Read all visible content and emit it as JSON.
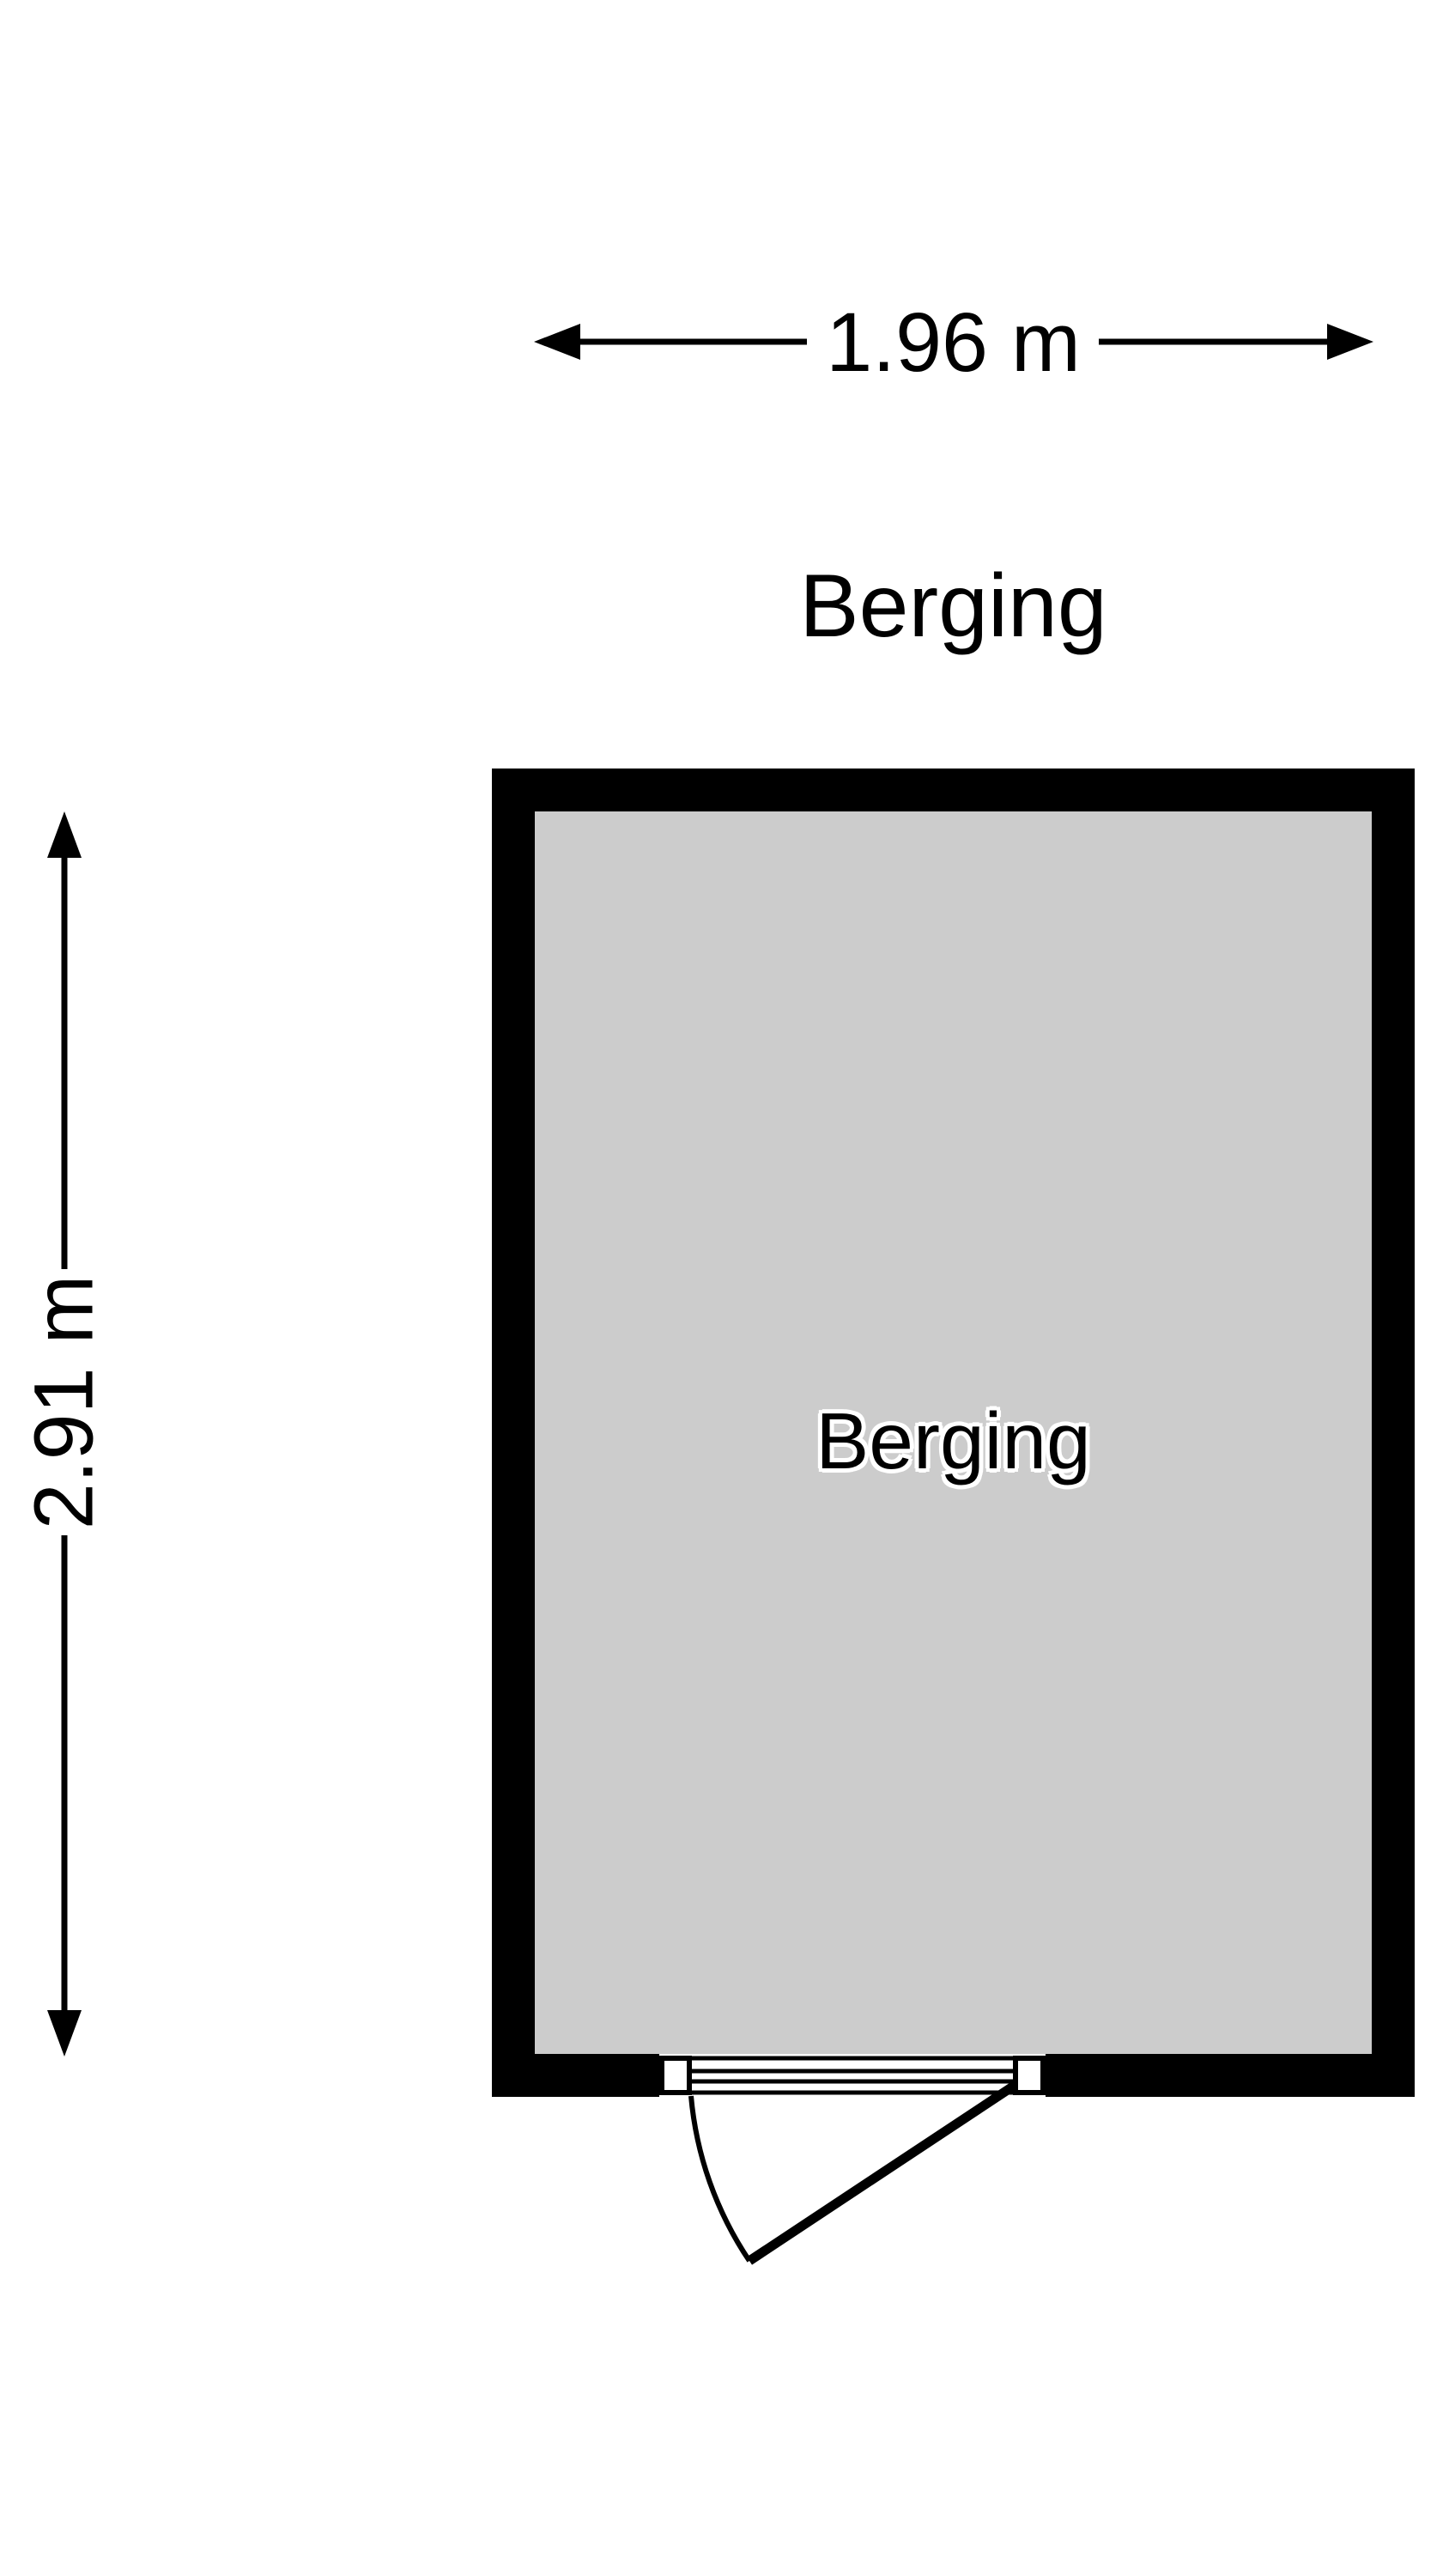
{
  "floorplan": {
    "title": "Berging",
    "room": {
      "name": "Berging",
      "width_label": "1.96 m",
      "depth_label": "2.91 m"
    },
    "colors": {
      "wall": "#000000",
      "floor": "#CCCCCC",
      "dimension": "#000000",
      "door": "#000000",
      "door_post_fill": "#FFFFFF",
      "room_label_halo": "#FFFFFF",
      "background": "#FFFFFF"
    }
  }
}
